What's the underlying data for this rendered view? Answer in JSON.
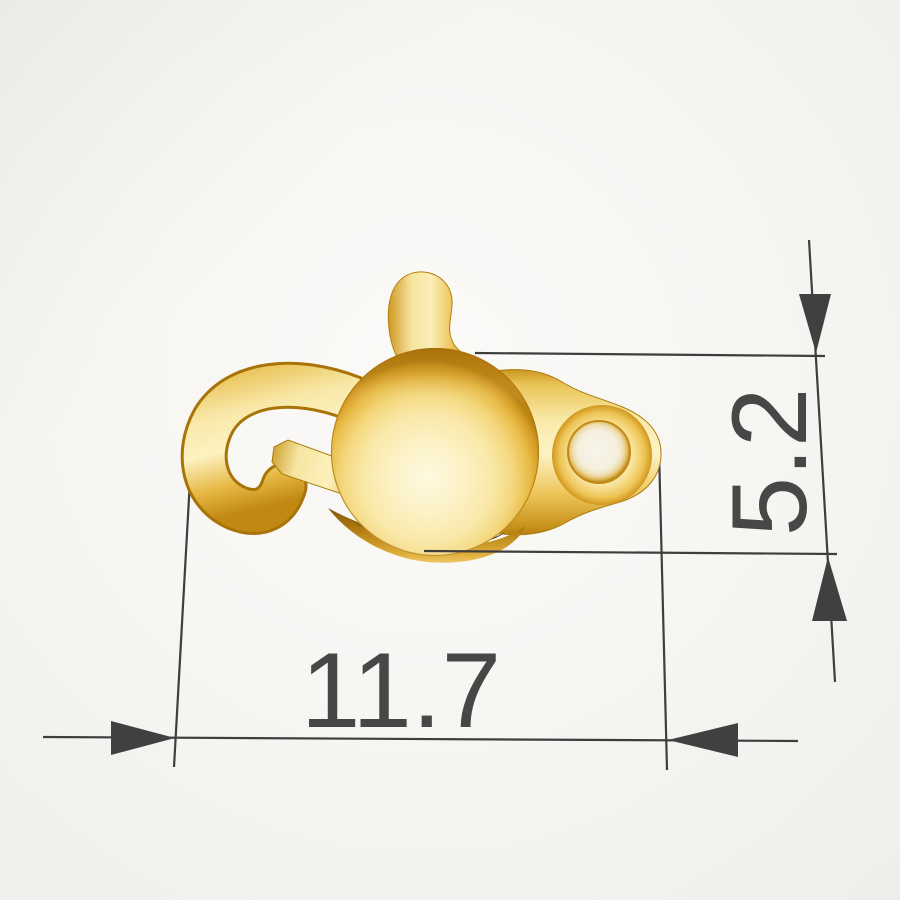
{
  "scene": {
    "background_color": "#f7f6f3",
    "object_name": "gold-sister-hook-clasp",
    "gold_highlight": "#fdf3c6",
    "gold_mid": "#f0c14b",
    "gold_shadow": "#b5800f",
    "recess_color": "#3f2402"
  },
  "annotations": {
    "line_color": "#3e3e3e",
    "arrow_color": "#404040",
    "text_color": "#474747",
    "font_size_px": 107,
    "width_dim": {
      "label": "11.7"
    },
    "height_dim": {
      "label": "5.2"
    }
  }
}
